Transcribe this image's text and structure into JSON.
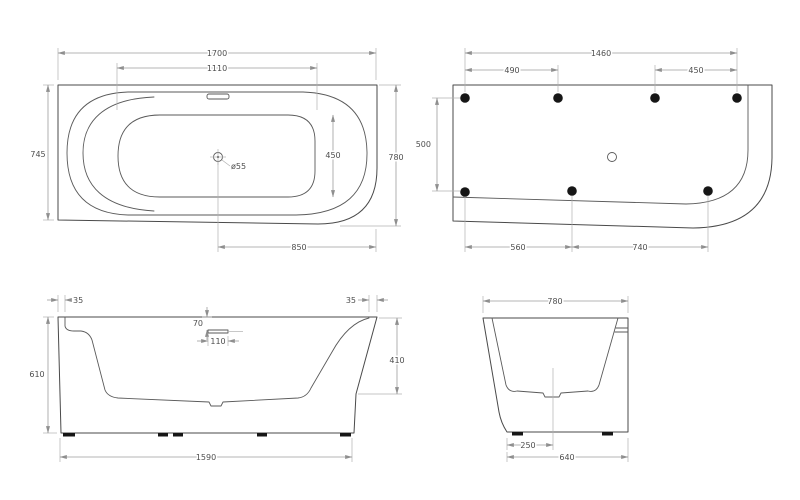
{
  "drawing": {
    "type": "bathtub technical drawing, four orthographic views",
    "colors": {
      "outline": "#4a4a4a",
      "dimension_lines": "#9c9c9c",
      "text": "#4f4f4f",
      "fixing_dots": "#161616",
      "background": "#ffffff"
    },
    "views": {
      "plan": {
        "name": "top plan view",
        "dims": {
          "overall_length": "1700",
          "basin_length": "1110",
          "left_width": "745",
          "right_width": "780",
          "basin_width": "450",
          "drain_diameter": "ø55",
          "drain_to_right_edge": "850"
        }
      },
      "underside": {
        "name": "bottom fixing view",
        "dims": {
          "fixing_span_length": "1460",
          "fixing_gap_left": "490",
          "fixing_gap_right": "450",
          "fixing_row_spacing": "500",
          "fixing_gap_bottom_left": "560",
          "fixing_gap_bottom_right": "740"
        }
      },
      "side": {
        "name": "long side elevation",
        "dims": {
          "rim_offset_left": "35",
          "rim_offset_right": "35",
          "overflow_depth": "70",
          "overflow_length": "110",
          "overall_height": "610",
          "right_inner_height": "410",
          "base_length": "1590"
        }
      },
      "end": {
        "name": "end elevation",
        "dims": {
          "overall_width": "780",
          "drain_offset": "250",
          "base_width": "640"
        }
      }
    }
  }
}
